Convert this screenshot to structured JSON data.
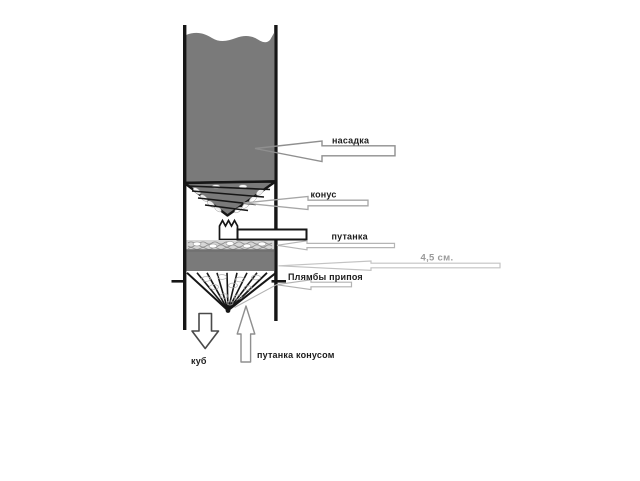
{
  "diagram": {
    "type": "distillation-column-packing-sketch",
    "labels": {
      "nasadka": "насадка",
      "konus": "конус",
      "putanka": "путанка",
      "dimension": "4,5 см.",
      "plyamby_pripoya": "Плямбы припоя",
      "kub": "куб",
      "putanka_konusom": "путанка конусом"
    },
    "colors": {
      "packing_gray": "#7a7a7a",
      "band_gray": "#7a7a7a",
      "outline_black": "#161616",
      "callout_dark_gray": "#8f8f8f",
      "callout_light_gray": "#b5b5b5",
      "dim_text_gray": "#9a9a9a",
      "background": "#ffffff"
    }
  }
}
